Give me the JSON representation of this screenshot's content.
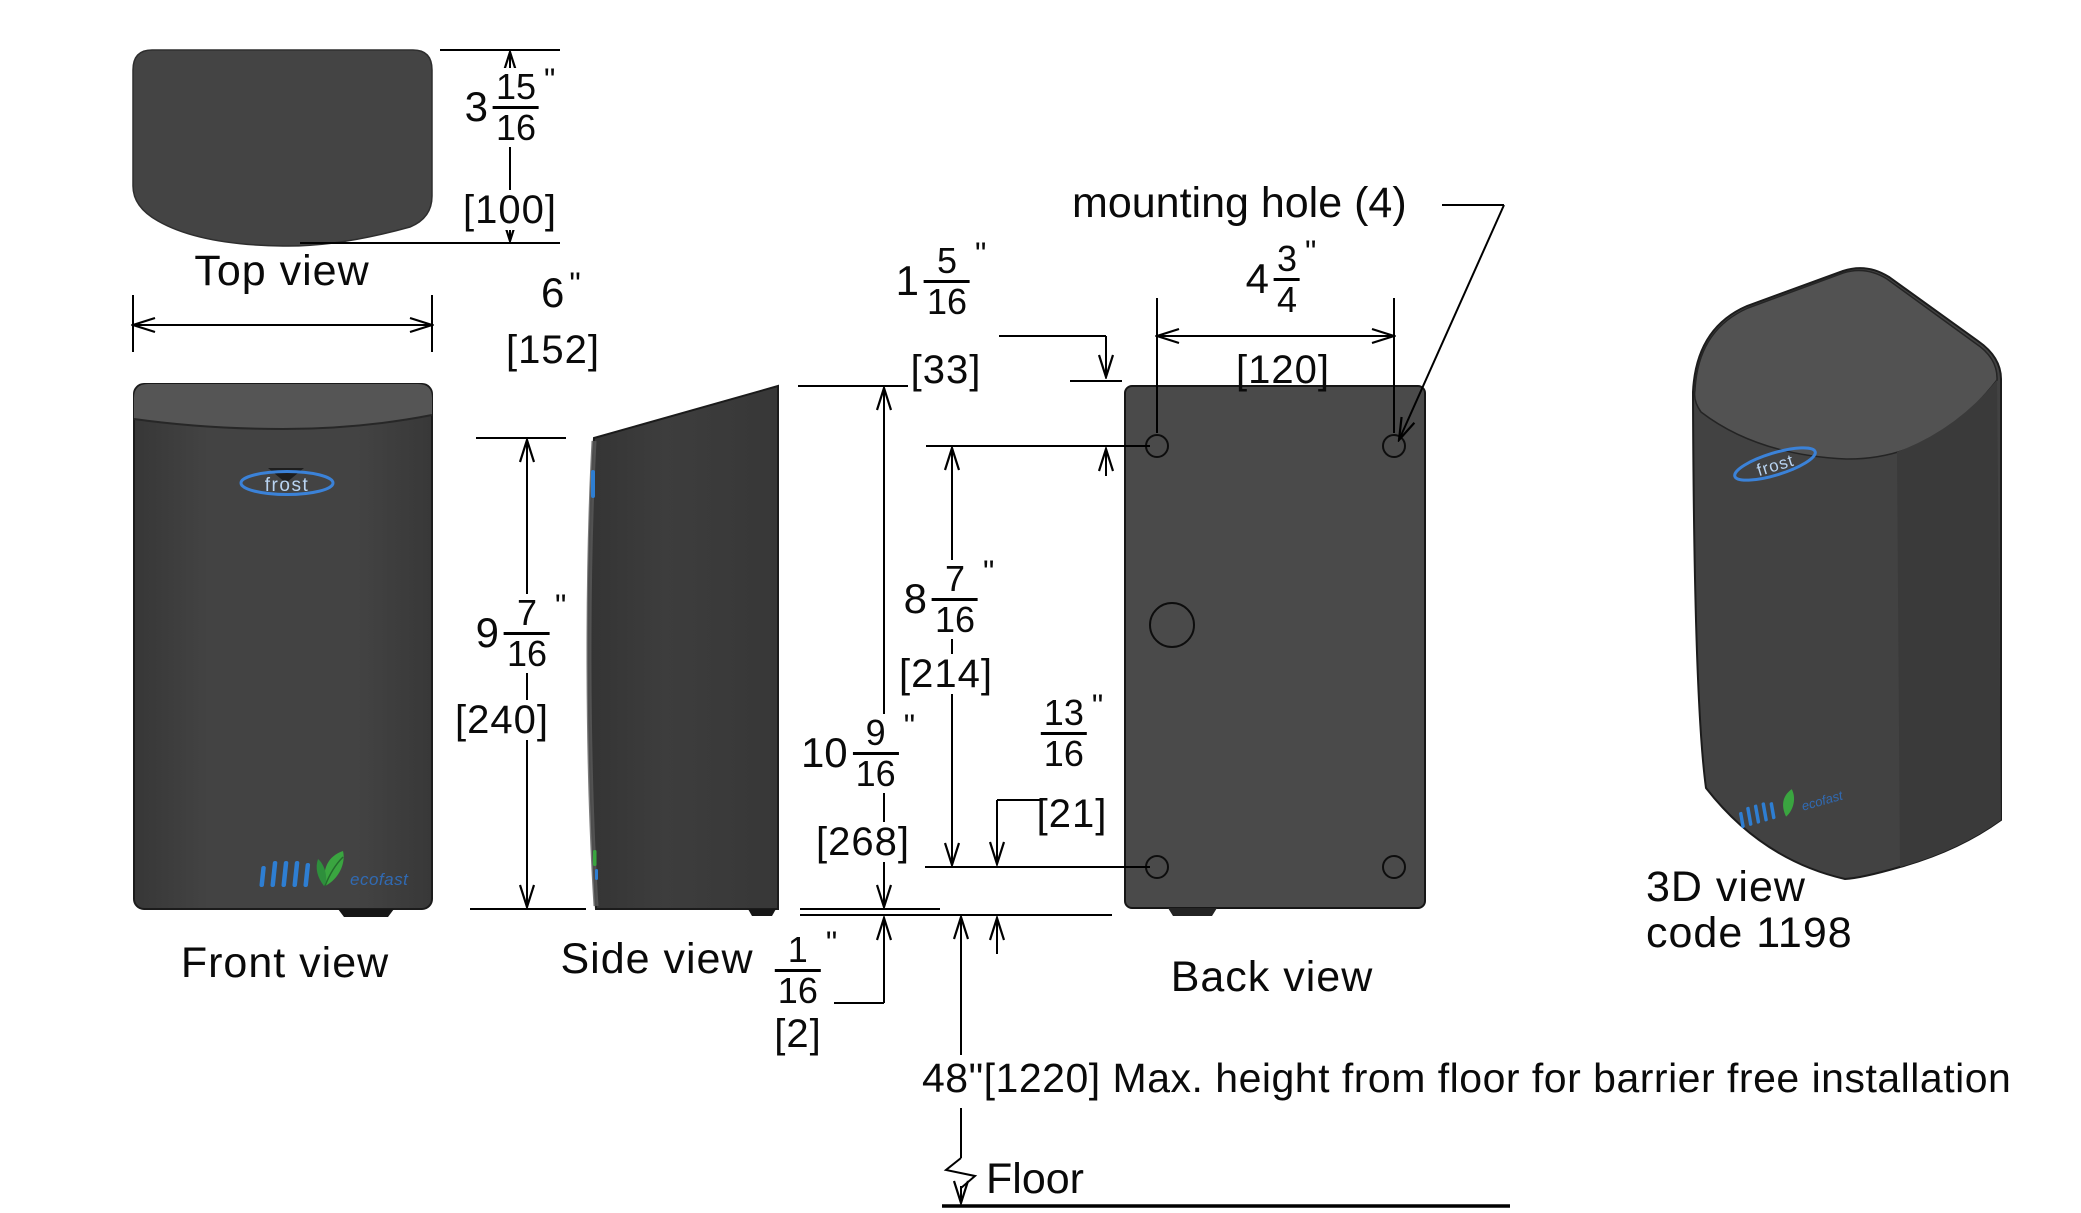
{
  "drawing": {
    "views": {
      "top": "Top view",
      "front": "Front view",
      "side": "Side view",
      "back": "Back view",
      "three_d": "3D view",
      "three_d_code": "code 1198"
    },
    "annotations": {
      "mounting_hole": "mounting hole (4)",
      "install_note": "48\"[1220] Max. height from floor for barrier free installation",
      "floor": "Floor"
    },
    "brand": {
      "logo": "frost",
      "eco_wordmark": "ecofast"
    },
    "dims": {
      "depth": {
        "whole": "3",
        "num": "15",
        "den": "16",
        "unit": "\"",
        "mm": "[100]"
      },
      "width": {
        "whole": "6",
        "unit": "\"",
        "mm": "[152]"
      },
      "front_height": {
        "whole": "9",
        "num": "7",
        "den": "16",
        "unit": "\"",
        "mm": "[240]"
      },
      "overall_height": {
        "whole": "10",
        "num": "9",
        "den": "16",
        "unit": "\"",
        "mm": "[268]"
      },
      "hole_top_offset": {
        "whole": "1",
        "num": "5",
        "den": "16",
        "unit": "\"",
        "mm": "[33]"
      },
      "hole_vertical_spacing": {
        "whole": "8",
        "num": "7",
        "den": "16",
        "unit": "\"",
        "mm": "[214]"
      },
      "hole_horizontal_spacing": {
        "whole": "4",
        "num": "3",
        "den": "4",
        "unit": "\"",
        "mm": "[120]"
      },
      "hole_bottom_offset": {
        "num": "13",
        "den": "16",
        "unit": "\"",
        "mm": "[21]"
      },
      "bottom_lip": {
        "num": "1",
        "den": "16",
        "unit": "\"",
        "mm": "[2]"
      }
    },
    "colors": {
      "body_gray": "#424242",
      "body_light_gray": "#545454",
      "back_panel_gray": "#4a4a4a",
      "line_black": "#000000",
      "brand_blue": "#3b82d8",
      "eco_text_blue": "#2f6fc0",
      "leaf_green": "#3aa540"
    }
  }
}
